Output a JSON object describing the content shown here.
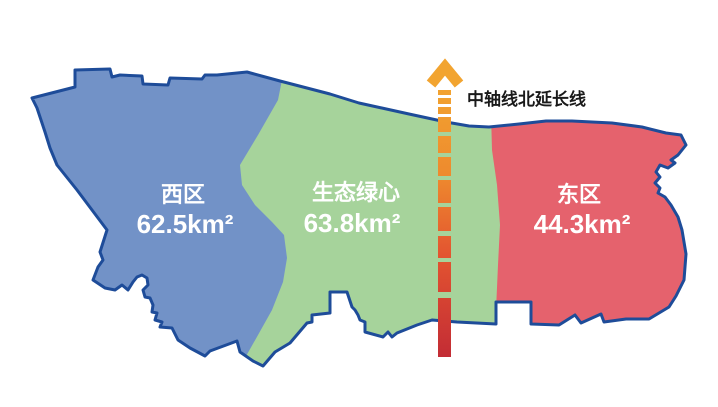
{
  "map": {
    "regions": {
      "west": {
        "name": "西区",
        "area": "62.5km²"
      },
      "green_heart": {
        "name": "生态绿心",
        "area": "63.8km²"
      },
      "east": {
        "name": "东区",
        "area": "44.3km²"
      }
    },
    "axis": {
      "label": "中轴线北延长线"
    },
    "colors": {
      "west_fill": "#7292C7",
      "green_fill": "#A6D39B",
      "east_fill": "#E5626D",
      "outline": "#1E4C99",
      "axis_top": "#F2A430",
      "axis_upper_mid": "#EE8A2E",
      "axis_lower_mid": "#E35430",
      "axis_bottom": "#C22B35",
      "region_label_text": "#FFFFFF",
      "axis_label_text": "#1A1A1A",
      "background": "#FFFFFF"
    }
  }
}
